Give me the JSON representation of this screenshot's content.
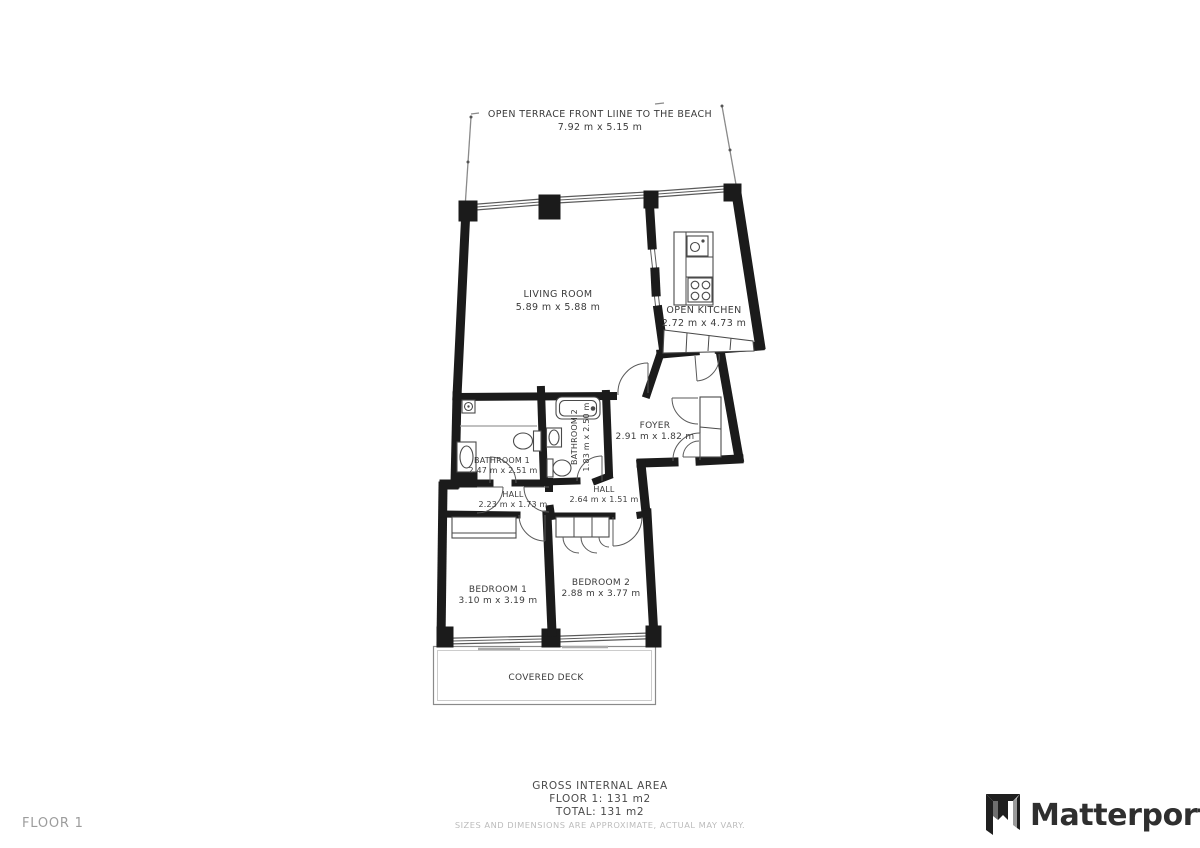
{
  "floor_plan": {
    "terrace": {
      "name": "OPEN TERRACE FRONT LIINE TO THE BEACH",
      "dims": "7.92 m x 5.15 m"
    },
    "living_room": {
      "name": "LIVING ROOM",
      "dims": "5.89 m x 5.88 m"
    },
    "kitchen": {
      "name": "OPEN KITCHEN",
      "dims": "2.72 m x 4.73 m"
    },
    "foyer": {
      "name": "FOYER",
      "dims": "2.91 m x 1.82 m"
    },
    "bathroom1": {
      "name": "BATHROOM 1",
      "dims": "2.47 m x 2.51 m"
    },
    "bathroom2": {
      "name": "BATHROOM 2",
      "dims": "1.83 m x 2.50 m"
    },
    "hall1": {
      "name": "HALL",
      "dims": "2.23 m x 1.73 m"
    },
    "hall2": {
      "name": "HALL",
      "dims": "2.64 m x 1.51 m"
    },
    "bedroom1": {
      "name": "BEDROOM 1",
      "dims": "3.10 m x 3.19 m"
    },
    "bedroom2": {
      "name": "BEDROOM 2",
      "dims": "2.88 m x 3.77 m"
    },
    "deck": {
      "name": "COVERED DECK"
    }
  },
  "footer": {
    "area_title": "GROSS INTERNAL AREA",
    "floor_area": "FLOOR 1: 131 m2",
    "total_area": "TOTAL: 131 m2",
    "disclaimer": "SIZES AND DIMENSIONS ARE APPROXIMATE, ACTUAL MAY VARY."
  },
  "floor_label": "FLOOR 1",
  "brand": {
    "wordmark": "Matterport"
  },
  "colors": {
    "wall": "#1b1b1b",
    "thin_line": "#8a8a8a",
    "text": "#3b3b3b",
    "muted": "#bcbcbc",
    "background": "#ffffff"
  }
}
